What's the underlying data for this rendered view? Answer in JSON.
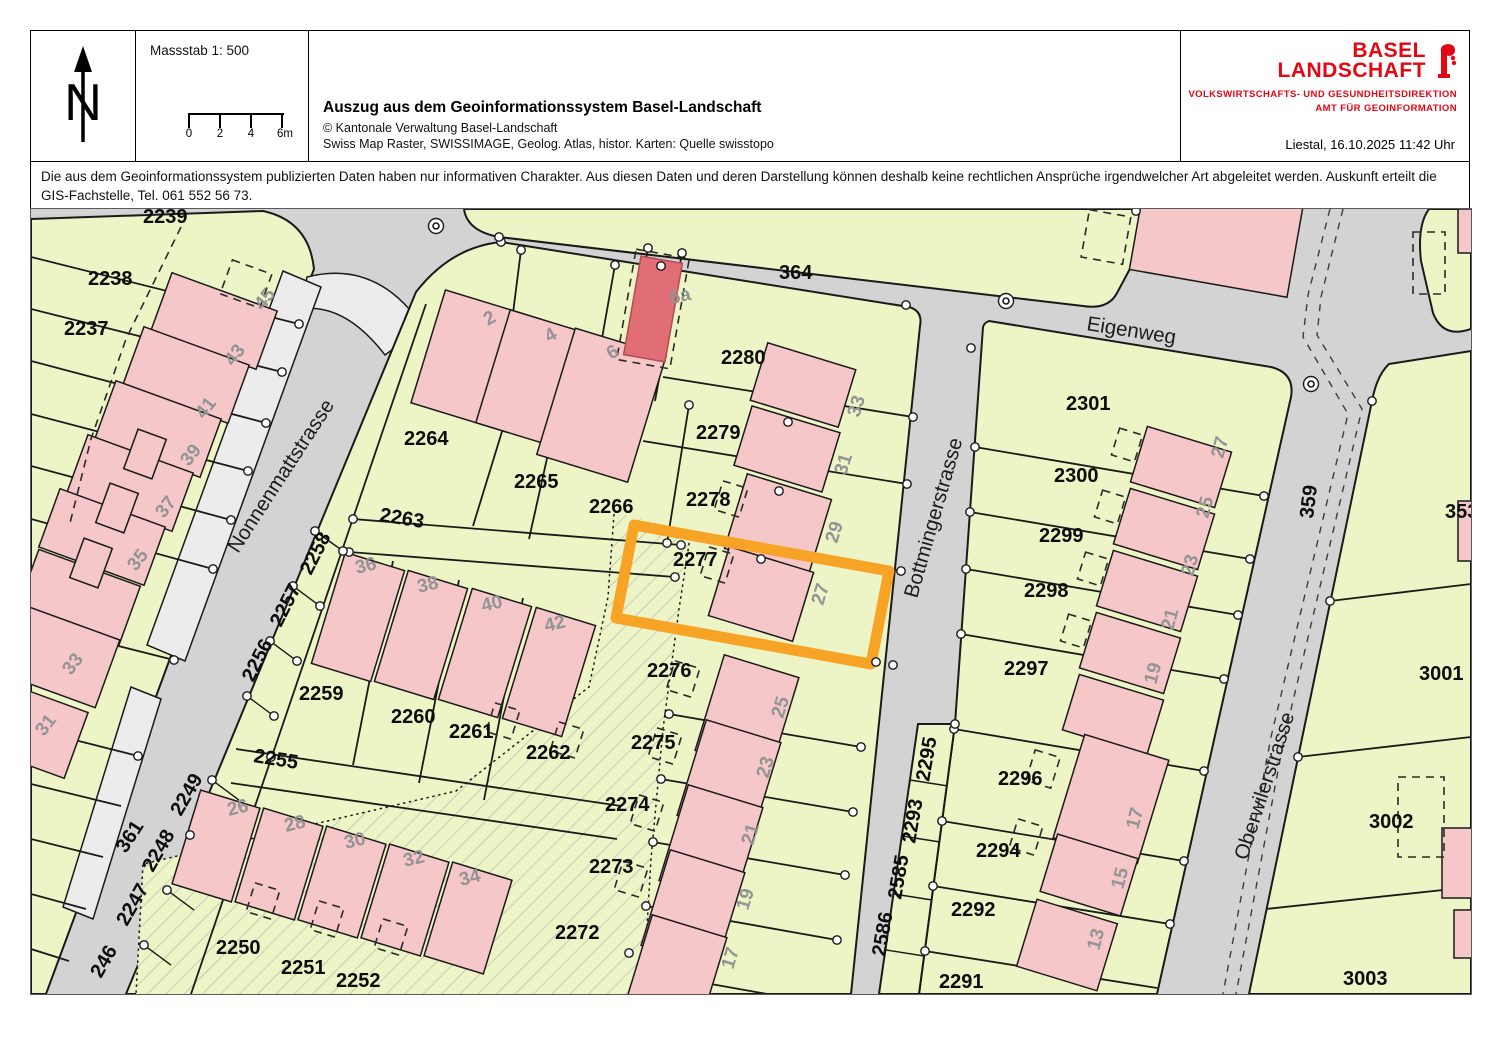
{
  "header": {
    "scale_label": "Massstab 1: 500",
    "scalebar_ticks": [
      "0",
      "2",
      "4",
      "6m"
    ],
    "title": "Auszug aus dem Geoinformationssystem Basel-Landschaft",
    "copyright": "© Kantonale Verwaltung Basel-Landschaft",
    "sources": "Swiss Map Raster, SWISSIMAGE, Geolog. Atlas, histor. Karten: Quelle swisstopo",
    "logo": {
      "line1": "BASEL",
      "line2": "LANDSCHAFT",
      "dept": "VOLKSWIRTSCHAFTS- UND GESUNDHEITSDIREKTION",
      "office": "AMT FÜR GEOINFORMATION"
    },
    "date_line": "Liestal, 16.10.2025 11:42 Uhr"
  },
  "disclaimer": "Die aus dem Geoinformationssystem publizierten Daten haben nur informativen Charakter. Aus diesen Daten und deren Darstellung können deshalb keine rechtlichen Ansprüche irgendwelcher Art abgeleitet werden. Auskunft erteilt die GIS-Fachstelle, Tel. 061 552 56 73.",
  "map": {
    "highlighted_parcel": "2277",
    "colors": {
      "street": "#d3d3d3",
      "parcel": "#edf4c5",
      "bld": "#f6c7c9",
      "bldred": "#e16d75",
      "light": "#ececec",
      "hl": "#f7a426",
      "lgray": "#949494",
      "brand": "#e30613"
    },
    "street_names": [
      "Nonnenmattstrasse",
      "Eigenweg",
      "Bottmingerstrasse",
      "Oberwilerstrasse"
    ],
    "labels": [
      {
        "t": "2239",
        "x": 112,
        "y": 14,
        "r": 0,
        "c": "p"
      },
      {
        "t": "2238",
        "x": 57,
        "y": 76,
        "r": 0,
        "c": "p"
      },
      {
        "t": "2237",
        "x": 33,
        "y": 126,
        "r": 0,
        "c": "p"
      },
      {
        "t": "2264",
        "x": 373,
        "y": 236,
        "r": 0,
        "c": "p"
      },
      {
        "t": "2265",
        "x": 483,
        "y": 279,
        "r": 0,
        "c": "p"
      },
      {
        "t": "2266",
        "x": 558,
        "y": 304,
        "r": 0,
        "c": "p"
      },
      {
        "t": "2263",
        "x": 348,
        "y": 312,
        "r": 9,
        "c": "p"
      },
      {
        "t": "2280",
        "x": 690,
        "y": 155,
        "r": 0,
        "c": "p"
      },
      {
        "t": "2279",
        "x": 665,
        "y": 230,
        "r": 0,
        "c": "p"
      },
      {
        "t": "2278",
        "x": 655,
        "y": 297,
        "r": 0,
        "c": "p"
      },
      {
        "t": "2277",
        "x": 642,
        "y": 357,
        "r": 0,
        "c": "p"
      },
      {
        "t": "2276",
        "x": 616,
        "y": 468,
        "r": 0,
        "c": "p"
      },
      {
        "t": "2275",
        "x": 600,
        "y": 540,
        "r": 0,
        "c": "p"
      },
      {
        "t": "2274",
        "x": 574,
        "y": 602,
        "r": 0,
        "c": "p"
      },
      {
        "t": "2273",
        "x": 558,
        "y": 664,
        "r": 0,
        "c": "p"
      },
      {
        "t": "2272",
        "x": 524,
        "y": 730,
        "r": 0,
        "c": "p"
      },
      {
        "t": "2259",
        "x": 268,
        "y": 491,
        "r": 0,
        "c": "p"
      },
      {
        "t": "2260",
        "x": 360,
        "y": 514,
        "r": 0,
        "c": "p"
      },
      {
        "t": "2261",
        "x": 418,
        "y": 529,
        "r": 0,
        "c": "p"
      },
      {
        "t": "2262",
        "x": 495,
        "y": 550,
        "r": 0,
        "c": "p"
      },
      {
        "t": "2255",
        "x": 222,
        "y": 553,
        "r": 9,
        "c": "p"
      },
      {
        "t": "2250",
        "x": 185,
        "y": 745,
        "r": 0,
        "c": "p"
      },
      {
        "t": "2251",
        "x": 250,
        "y": 765,
        "r": 0,
        "c": "p"
      },
      {
        "t": "2252",
        "x": 305,
        "y": 778,
        "r": 0,
        "c": "p"
      },
      {
        "t": "2258",
        "x": 280,
        "y": 367,
        "r": -63,
        "c": "p"
      },
      {
        "t": "2257",
        "x": 250,
        "y": 419,
        "r": -63,
        "c": "p"
      },
      {
        "t": "2256",
        "x": 222,
        "y": 474,
        "r": -63,
        "c": "p"
      },
      {
        "t": "2249",
        "x": 150,
        "y": 608,
        "r": -60,
        "c": "p"
      },
      {
        "t": "2248",
        "x": 122,
        "y": 664,
        "r": -60,
        "c": "p"
      },
      {
        "t": "2247",
        "x": 96,
        "y": 718,
        "r": -60,
        "c": "p"
      },
      {
        "t": "246",
        "x": 70,
        "y": 770,
        "r": -60,
        "c": "p"
      },
      {
        "t": "2301",
        "x": 1035,
        "y": 201,
        "r": 0,
        "c": "p"
      },
      {
        "t": "2300",
        "x": 1023,
        "y": 273,
        "r": 0,
        "c": "p"
      },
      {
        "t": "2299",
        "x": 1008,
        "y": 333,
        "r": 0,
        "c": "p"
      },
      {
        "t": "2298",
        "x": 993,
        "y": 388,
        "r": 0,
        "c": "p"
      },
      {
        "t": "2297",
        "x": 973,
        "y": 466,
        "r": 0,
        "c": "p"
      },
      {
        "t": "2296",
        "x": 967,
        "y": 576,
        "r": 0,
        "c": "p"
      },
      {
        "t": "2294",
        "x": 945,
        "y": 648,
        "r": 0,
        "c": "p"
      },
      {
        "t": "2292",
        "x": 920,
        "y": 707,
        "r": 0,
        "c": "p"
      },
      {
        "t": "2291",
        "x": 908,
        "y": 779,
        "r": 0,
        "c": "p"
      },
      {
        "t": "2295",
        "x": 898,
        "y": 573,
        "r": -80,
        "c": "p"
      },
      {
        "t": "2293",
        "x": 884,
        "y": 635,
        "r": -80,
        "c": "p"
      },
      {
        "t": "2585",
        "x": 870,
        "y": 691,
        "r": -80,
        "c": "p"
      },
      {
        "t": "2586",
        "x": 854,
        "y": 748,
        "r": -80,
        "c": "p"
      },
      {
        "t": "353",
        "x": 1414,
        "y": 309,
        "r": 0,
        "c": "p"
      },
      {
        "t": "3001",
        "x": 1388,
        "y": 471,
        "r": 0,
        "c": "p"
      },
      {
        "t": "3002",
        "x": 1338,
        "y": 619,
        "r": 0,
        "c": "p"
      },
      {
        "t": "3003",
        "x": 1312,
        "y": 776,
        "r": 0,
        "c": "p"
      },
      {
        "t": "364",
        "x": 748,
        "y": 70,
        "r": 0,
        "c": "p"
      },
      {
        "t": "361",
        "x": 95,
        "y": 645,
        "r": -57,
        "c": "p"
      },
      {
        "t": "359",
        "x": 1282,
        "y": 310,
        "r": -83,
        "c": "p"
      },
      {
        "t": "45",
        "x": 232,
        "y": 102,
        "r": -52,
        "c": "h"
      },
      {
        "t": "43",
        "x": 202,
        "y": 158,
        "r": -52,
        "c": "h"
      },
      {
        "t": "41",
        "x": 173,
        "y": 211,
        "r": -52,
        "c": "h"
      },
      {
        "t": "39",
        "x": 158,
        "y": 258,
        "r": -52,
        "c": "h"
      },
      {
        "t": "37",
        "x": 133,
        "y": 310,
        "r": -52,
        "c": "h"
      },
      {
        "t": "35",
        "x": 105,
        "y": 363,
        "r": -52,
        "c": "h"
      },
      {
        "t": "33",
        "x": 40,
        "y": 467,
        "r": -52,
        "c": "h"
      },
      {
        "t": "31",
        "x": 13,
        "y": 528,
        "r": -52,
        "c": "h"
      },
      {
        "t": "2",
        "x": 457,
        "y": 117,
        "r": -30,
        "c": "h"
      },
      {
        "t": "4",
        "x": 518,
        "y": 134,
        "r": -30,
        "c": "h"
      },
      {
        "t": "6",
        "x": 580,
        "y": 151,
        "r": -30,
        "c": "h"
      },
      {
        "t": "6a",
        "x": 640,
        "y": 95,
        "r": -12,
        "c": "h"
      },
      {
        "t": "33",
        "x": 828,
        "y": 209,
        "r": -73,
        "c": "h"
      },
      {
        "t": "31",
        "x": 815,
        "y": 267,
        "r": -73,
        "c": "h"
      },
      {
        "t": "29",
        "x": 806,
        "y": 335,
        "r": -73,
        "c": "h"
      },
      {
        "t": "27",
        "x": 792,
        "y": 397,
        "r": -73,
        "c": "h"
      },
      {
        "t": "25",
        "x": 752,
        "y": 510,
        "r": -73,
        "c": "h"
      },
      {
        "t": "23",
        "x": 737,
        "y": 570,
        "r": -73,
        "c": "h"
      },
      {
        "t": "21",
        "x": 722,
        "y": 637,
        "r": -73,
        "c": "h"
      },
      {
        "t": "19",
        "x": 717,
        "y": 702,
        "r": -73,
        "c": "h"
      },
      {
        "t": "17",
        "x": 702,
        "y": 761,
        "r": -73,
        "c": "h"
      },
      {
        "t": "36",
        "x": 326,
        "y": 365,
        "r": -14,
        "c": "h"
      },
      {
        "t": "38",
        "x": 388,
        "y": 384,
        "r": -14,
        "c": "h"
      },
      {
        "t": "40",
        "x": 452,
        "y": 403,
        "r": -14,
        "c": "h"
      },
      {
        "t": "42",
        "x": 515,
        "y": 423,
        "r": -14,
        "c": "h"
      },
      {
        "t": "26",
        "x": 198,
        "y": 607,
        "r": -14,
        "c": "h"
      },
      {
        "t": "28",
        "x": 255,
        "y": 623,
        "r": -14,
        "c": "h"
      },
      {
        "t": "30",
        "x": 315,
        "y": 640,
        "r": -14,
        "c": "h"
      },
      {
        "t": "32",
        "x": 374,
        "y": 658,
        "r": -14,
        "c": "h"
      },
      {
        "t": "34",
        "x": 430,
        "y": 677,
        "r": -14,
        "c": "h"
      },
      {
        "t": "27",
        "x": 1192,
        "y": 250,
        "r": -75,
        "c": "h"
      },
      {
        "t": "25",
        "x": 1177,
        "y": 310,
        "r": -75,
        "c": "h"
      },
      {
        "t": "23",
        "x": 1162,
        "y": 368,
        "r": -75,
        "c": "h"
      },
      {
        "t": "21",
        "x": 1142,
        "y": 422,
        "r": -75,
        "c": "h"
      },
      {
        "t": "19",
        "x": 1125,
        "y": 476,
        "r": -75,
        "c": "h"
      },
      {
        "t": "17",
        "x": 1107,
        "y": 621,
        "r": -75,
        "c": "h"
      },
      {
        "t": "15",
        "x": 1092,
        "y": 681,
        "r": -75,
        "c": "h"
      },
      {
        "t": "13",
        "x": 1068,
        "y": 742,
        "r": -75,
        "c": "h"
      },
      {
        "t": "Nonnenmattstrasse",
        "x": 207,
        "y": 345,
        "r": -57,
        "c": "s"
      },
      {
        "t": "Eigenweg",
        "x": 1055,
        "y": 121,
        "r": 9,
        "c": "s"
      },
      {
        "t": "Bottmingerstrasse",
        "x": 886,
        "y": 390,
        "r": -74,
        "c": "s"
      },
      {
        "t": "Oberwilerstrasse",
        "x": 1216,
        "y": 652,
        "r": -72,
        "c": "s"
      }
    ]
  }
}
